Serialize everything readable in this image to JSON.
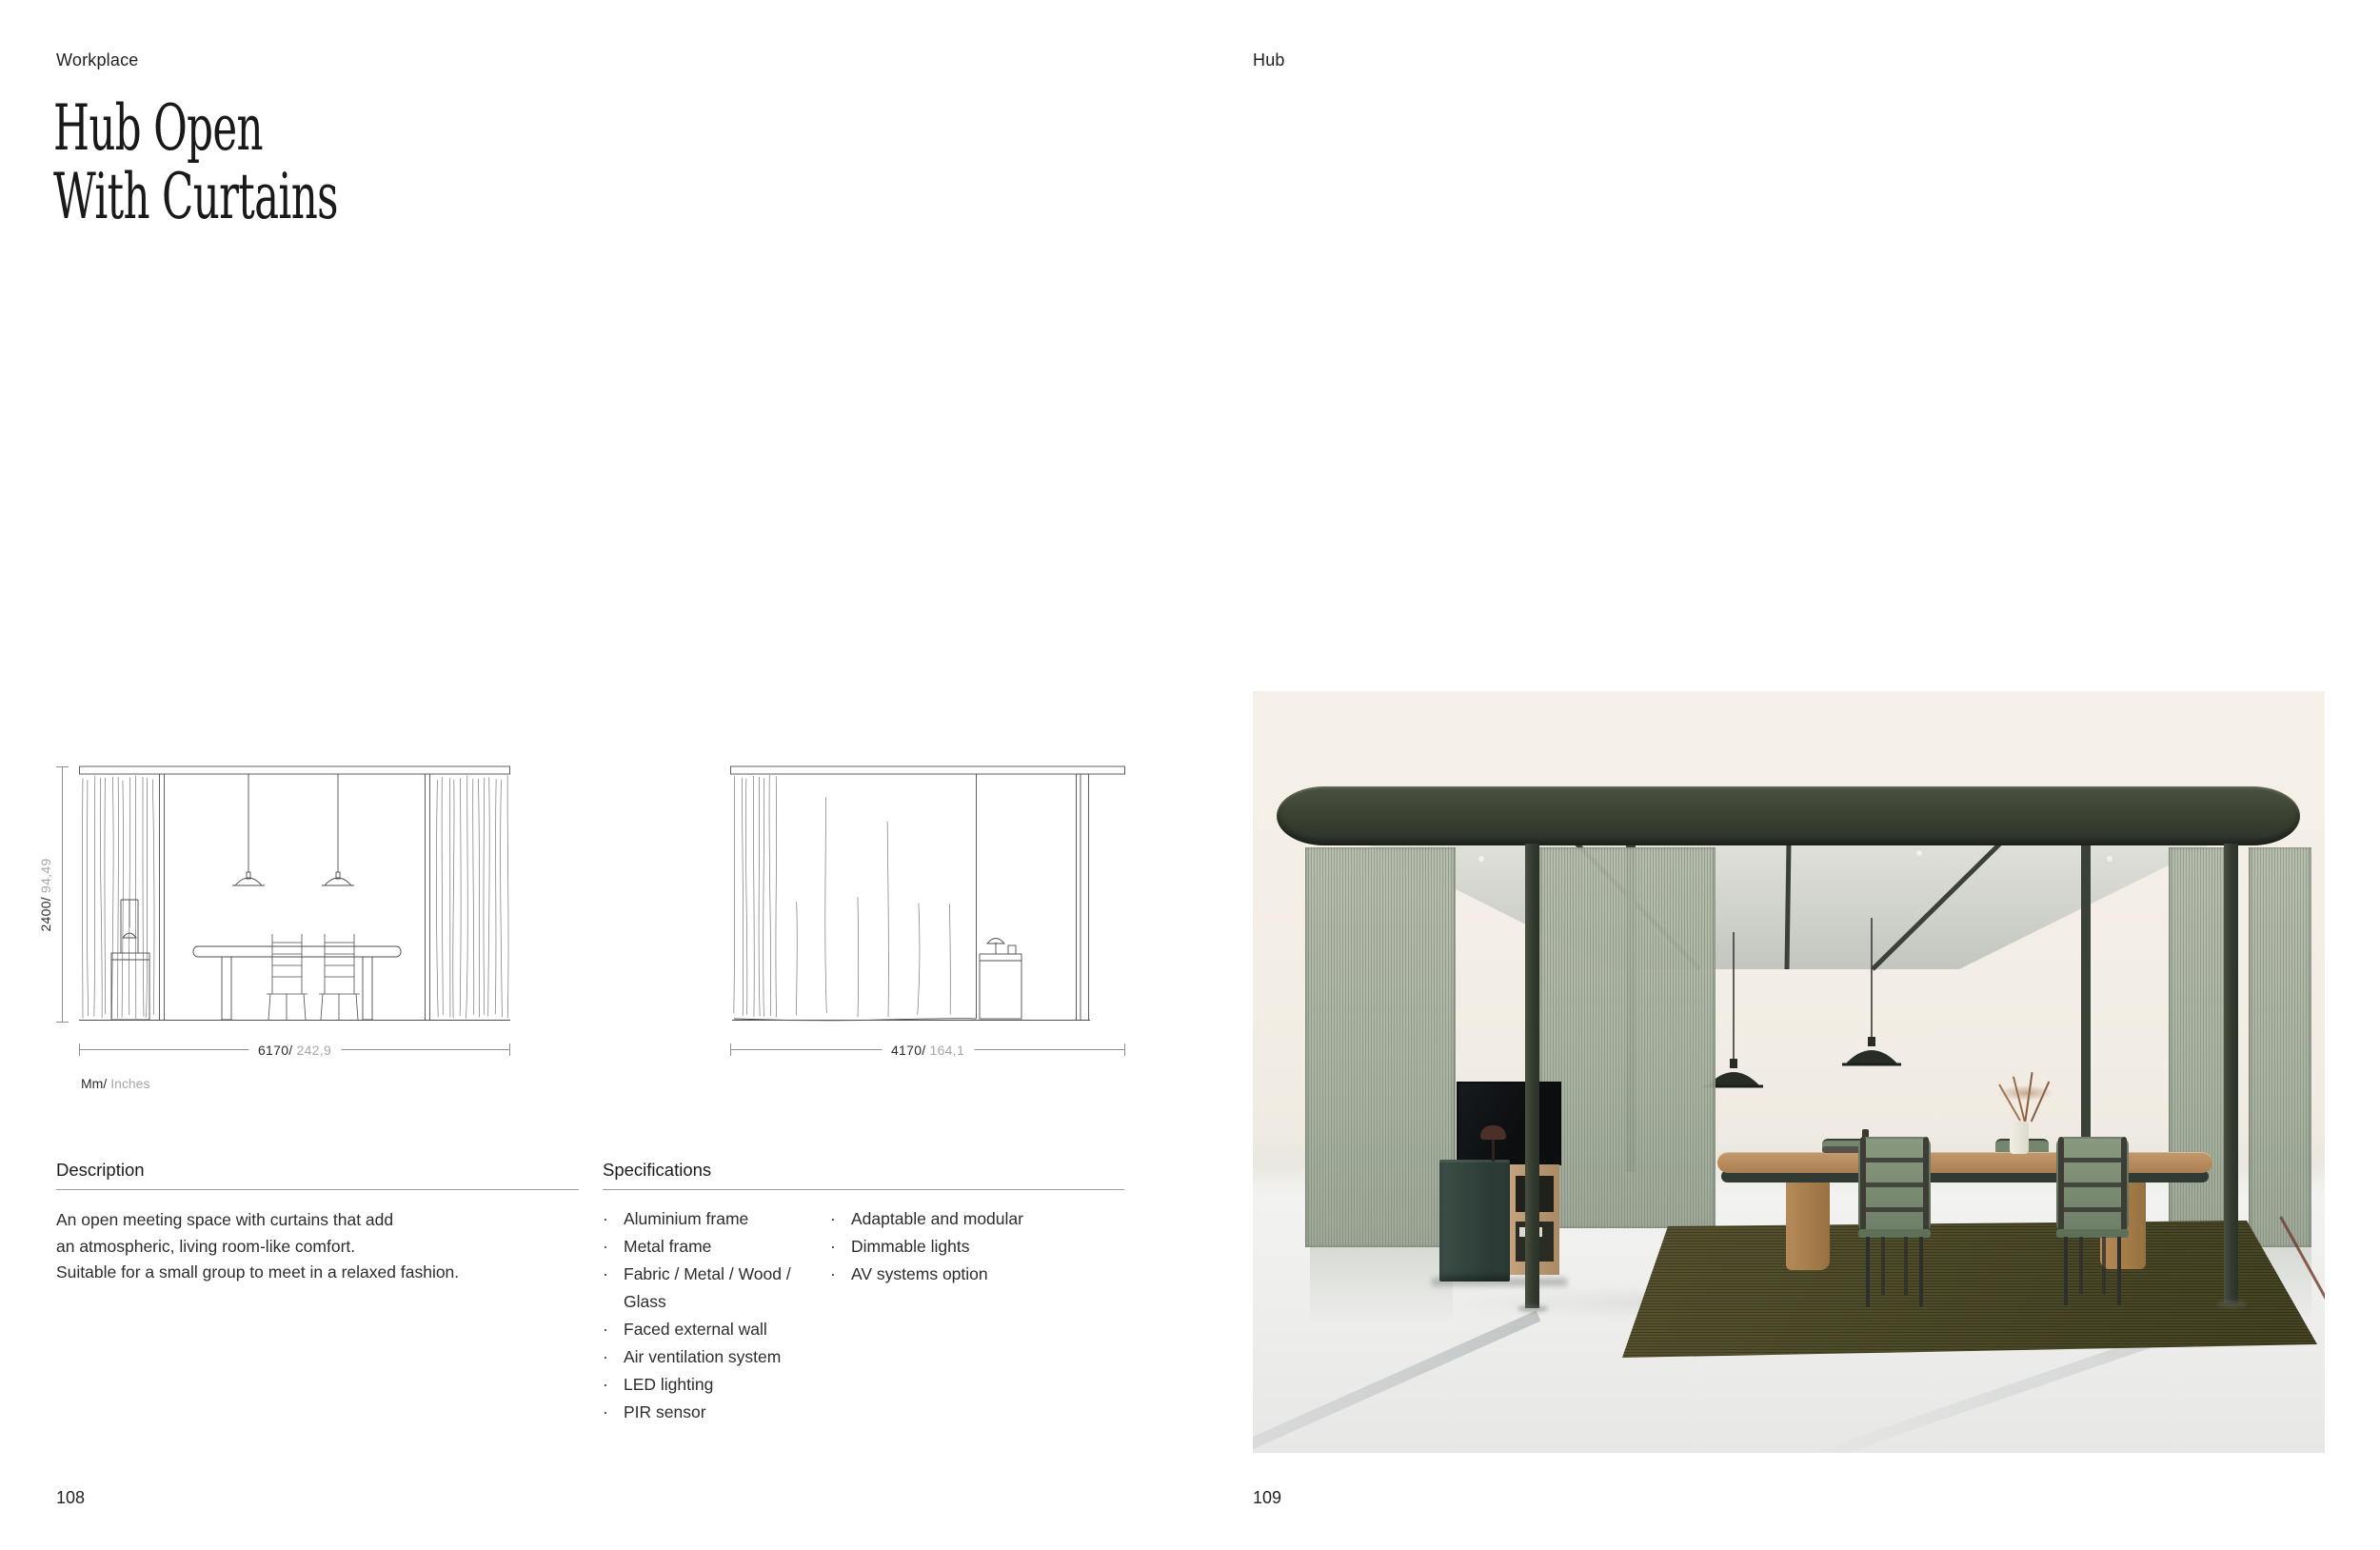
{
  "left_page": {
    "category": "Workplace",
    "title_lines": [
      "Hub Open",
      "With Curtains"
    ],
    "page_number": "108",
    "drawings": {
      "front": {
        "height_primary": "2400/",
        "height_secondary": "94,49",
        "width_primary": "6170/",
        "width_secondary": "242,9"
      },
      "side": {
        "width_primary": "4170/",
        "width_secondary": "164,1"
      },
      "units_primary": "Mm/",
      "units_secondary": "Inches"
    },
    "description": {
      "heading": "Description",
      "lines": [
        "An open meeting space with curtains that add",
        "an atmospheric, living room-like comfort.",
        "Suitable for a small group to meet in a relaxed fashion."
      ]
    },
    "specifications": {
      "heading": "Specifications",
      "column1": [
        {
          "text": "Aluminium frame",
          "bullet": true
        },
        {
          "text": "Metal frame",
          "bullet": true
        },
        {
          "text": "Fabric / Metal / Wood /",
          "bullet": true
        },
        {
          "text": "Glass",
          "bullet": false
        },
        {
          "text": "Faced external wall",
          "bullet": true
        },
        {
          "text": "Air ventilation system",
          "bullet": true
        },
        {
          "text": "LED lighting",
          "bullet": true
        },
        {
          "text": "PIR sensor",
          "bullet": true
        }
      ],
      "column2": [
        {
          "text": "Adaptable and modular",
          "bullet": true
        },
        {
          "text": "Dimmable lights",
          "bullet": true
        },
        {
          "text": "AV systems option",
          "bullet": true
        }
      ]
    }
  },
  "right_page": {
    "category": "Hub",
    "page_number": "109"
  },
  "render_colors": {
    "background_cream": "#f3eee5",
    "canopy_olive": "#39402f",
    "ceiling_gray": "#d8d9d3",
    "curtain_sage": "#a9b2a2",
    "chair_green": "#7d9076",
    "table_wood": "#b08a5e",
    "rug_olive": "#55512d",
    "cabinet_teal": "#36463f",
    "drawing_line": "#55565a",
    "dim_text_dark": "#2b2c2e",
    "dim_text_gray": "#a7a7a5"
  }
}
